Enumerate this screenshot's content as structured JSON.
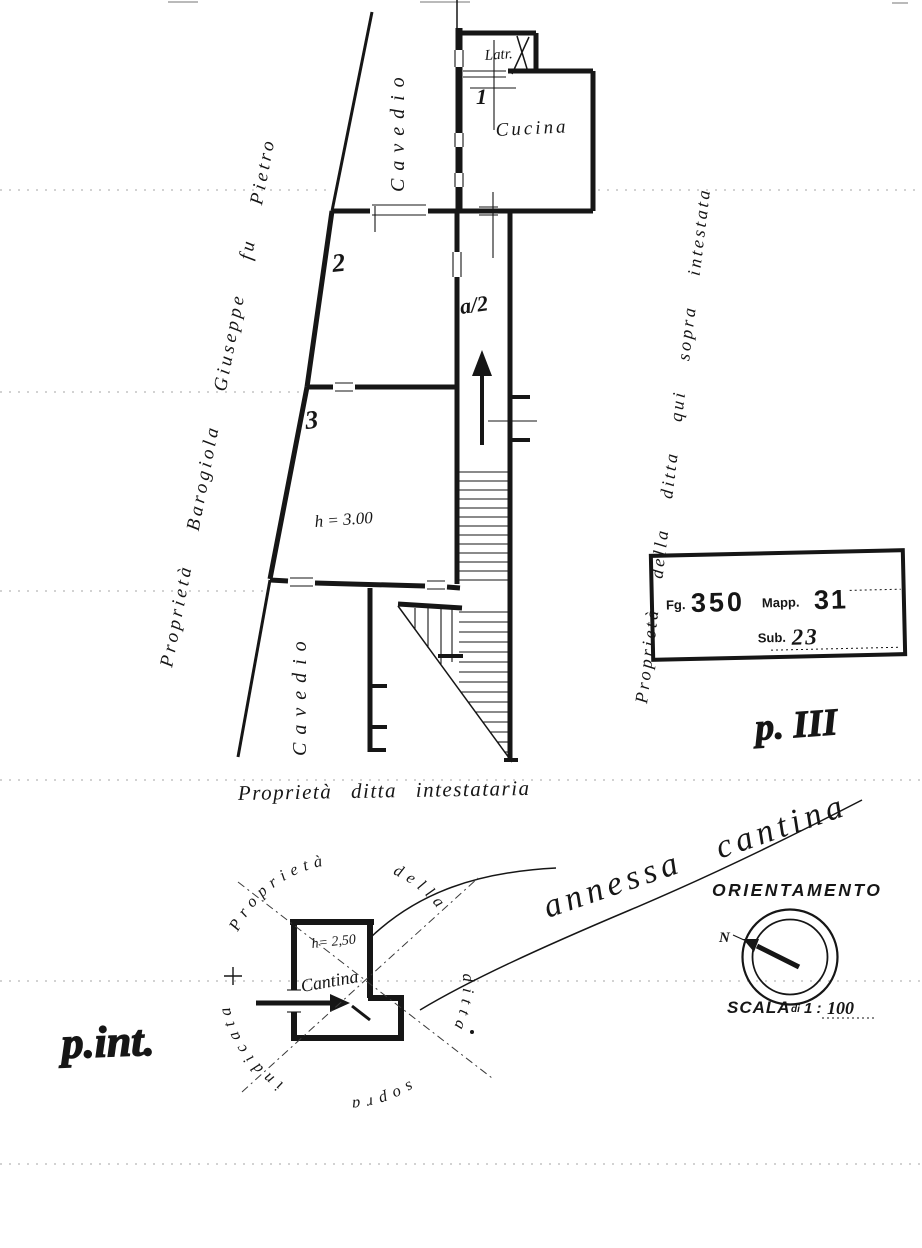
{
  "colors": {
    "ink": "#161616",
    "paper": "#ffffff"
  },
  "upper_plan": {
    "latrina_label": "Latr.",
    "room1_number": "1",
    "kitchen_label": "Cucina",
    "room2_number": "2",
    "room3_number": "3",
    "stair_flight_label": "a/2",
    "height_note": "h = 3.00",
    "cavedio_top": "Cavedio",
    "cavedio_bottom": "Cavedio",
    "owner_left": "Proprietà Barogiola Giuseppe fu Pietro",
    "owner_right": "Proprietà della ditta qui sopra intestata",
    "owner_bottom": "Proprietà ditta intestataria"
  },
  "stamp": {
    "fg_label": "Fg.",
    "fg_value": "350",
    "mapp_label": "Mapp.",
    "mapp_value": "31",
    "sub_label": "Sub.",
    "sub_value": "23"
  },
  "notes": {
    "floor_note": "p. III",
    "cursive_note": "annessa cantina",
    "basement_floor_note": "p.int."
  },
  "orientation": {
    "title": "ORIENTAMENTO",
    "north_label": "N"
  },
  "scale": {
    "label": "SCALA",
    "di": "di",
    "ratio": "1 :",
    "value": "100"
  },
  "basement_plan": {
    "height_note": "h= 2,50",
    "room_label": "Cantina",
    "ring_text": "Proprietà della ditta sopra indicata"
  }
}
